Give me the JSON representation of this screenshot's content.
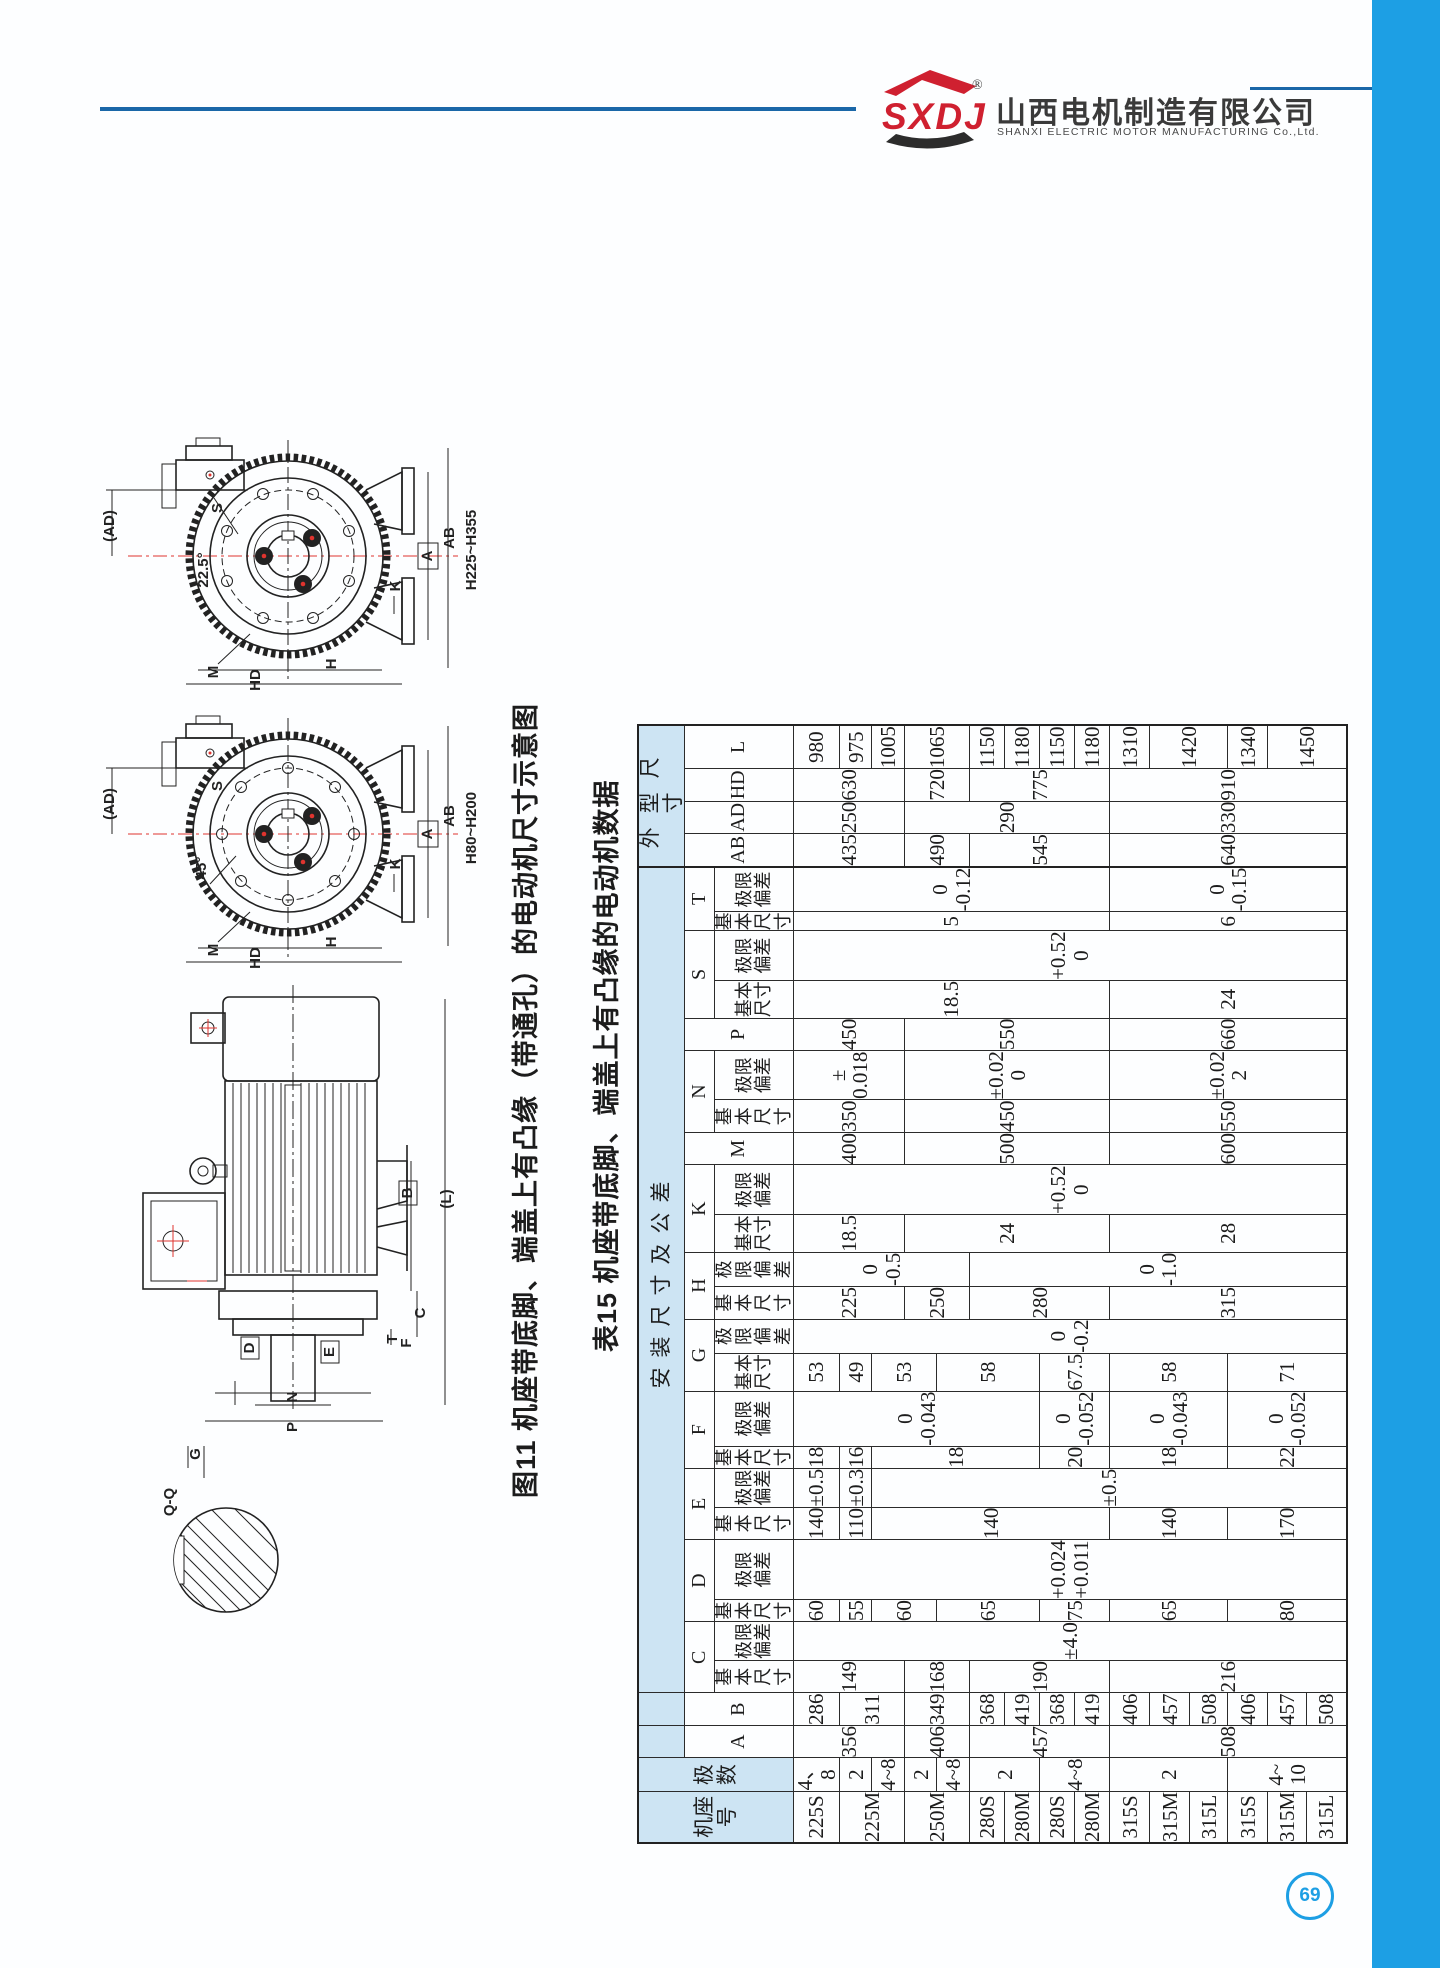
{
  "header": {
    "logo_text": "SXDJ",
    "reg_mark": "®",
    "company_cn": "山西电机制造有限公司",
    "company_en": "SHANXI ELECTRIC MOTOR MANUFACTURING Co.,Ltd."
  },
  "footer": {
    "page_number": "69"
  },
  "figure": {
    "caption": "图11 机座带底脚、端盖上有凸缘（带通孔）的电动机尺寸示意图",
    "labels": {
      "ad": "(AD)",
      "s": "S",
      "m": "M",
      "a": "A",
      "ab": "AB",
      "k": "K",
      "h": "H",
      "hd": "HD",
      "angle_top": "22.5°",
      "angle_bottom": "45°",
      "series_top": "H225~H355",
      "series_bottom": "H80~H200",
      "l": "(L)",
      "b": "B",
      "c": "C",
      "t": "T",
      "f": "F",
      "d": "D",
      "e": "E",
      "n": "N",
      "p": "P",
      "qq": "Q-Q",
      "g": "G"
    }
  },
  "table": {
    "title": "表15 机座带底脚、端盖上有凸缘的电动机数据",
    "col_widths": [
      48,
      50,
      40,
      38,
      50,
      60,
      48,
      66,
      56,
      70,
      48,
      70,
      70,
      70,
      62,
      70,
      66,
      70,
      50,
      50,
      58,
      48,
      56,
      56,
      56,
      70,
      40,
      36,
      46,
      52
    ],
    "head": [
      {
        "h": 40,
        "cells": [
          [
            "机座\n号",
            3,
            1,
            "hb"
          ],
          [
            "极数",
            3,
            1,
            "hb"
          ],
          [
            "",
            1,
            1,
            "hb"
          ],
          [
            "",
            1,
            1,
            "hb"
          ],
          [
            "安装尺寸及公差",
            1,
            22,
            "hb gi"
          ],
          [
            "外型尺寸",
            1,
            4,
            "hb go bl"
          ]
        ]
      },
      {
        "h": 30,
        "cells": [
          [
            "A",
            2,
            1,
            "hw"
          ],
          [
            "B",
            2,
            1,
            "hw"
          ],
          [
            "C",
            1,
            2,
            "hw"
          ],
          [
            "D",
            1,
            2,
            "hw"
          ],
          [
            "E",
            1,
            2,
            "hw"
          ],
          [
            "F",
            1,
            2,
            "hw"
          ],
          [
            "G",
            1,
            2,
            "hw"
          ],
          [
            "H",
            1,
            2,
            "hw"
          ],
          [
            "K",
            1,
            2,
            "hw"
          ],
          [
            "M",
            2,
            1,
            "hw"
          ],
          [
            "N",
            1,
            2,
            "hw"
          ],
          [
            "P",
            2,
            1,
            "hw"
          ],
          [
            "S",
            1,
            2,
            "hw"
          ],
          [
            "T",
            1,
            2,
            "hw"
          ],
          [
            "AB",
            2,
            1,
            "hw bl"
          ],
          [
            "AD",
            2,
            1,
            "hw"
          ],
          [
            "HD",
            2,
            1,
            "hw"
          ],
          [
            "L",
            2,
            1,
            "hw"
          ]
        ]
      },
      {
        "h": 74,
        "cells": [
          [
            "基本\n尺寸",
            1,
            1,
            "sub"
          ],
          [
            "极限\n偏差",
            1,
            1,
            "sub"
          ],
          [
            "基本\n尺寸",
            1,
            1,
            "sub"
          ],
          [
            "极限\n偏差",
            1,
            1,
            "sub"
          ],
          [
            "基本\n尺寸",
            1,
            1,
            "sub"
          ],
          [
            "极限\n偏差",
            1,
            1,
            "sub"
          ],
          [
            "基本\n尺寸",
            1,
            1,
            "sub"
          ],
          [
            "极限\n偏差",
            1,
            1,
            "sub"
          ],
          [
            "基本\n尺寸",
            1,
            1,
            "sub"
          ],
          [
            "极限\n偏差",
            1,
            1,
            "sub"
          ],
          [
            "基本\n尺寸",
            1,
            1,
            "sub"
          ],
          [
            "极限\n偏差",
            1,
            1,
            "sub"
          ],
          [
            "基本\n尺寸",
            1,
            1,
            "sub"
          ],
          [
            "极限\n偏差",
            1,
            1,
            "sub"
          ],
          [
            "基本\n尺寸",
            1,
            1,
            "sub"
          ],
          [
            "极限\n偏差",
            1,
            1,
            "sub"
          ],
          [
            "基本\n尺寸",
            1,
            1,
            "sub"
          ],
          [
            "极限\n偏差",
            1,
            1,
            "sub"
          ],
          [
            "基本\n尺寸",
            1,
            1,
            "sub"
          ],
          [
            "极限\n偏差",
            1,
            1,
            "sub"
          ]
        ]
      }
    ],
    "body": [
      {
        "h": 44,
        "cells": [
          [
            "225S"
          ],
          [
            "4、8"
          ],
          [
            "356",
            3
          ],
          [
            "286"
          ],
          [
            "149",
            3
          ],
          [
            "±4.0",
            15
          ],
          [
            "60"
          ],
          [
            "+0.024\n+0.011",
            15
          ],
          [
            "140"
          ],
          [
            "±0.5"
          ],
          [
            "18"
          ],
          [
            "0\n-0.043",
            7
          ],
          [
            "53"
          ],
          [
            "0\n-0.2",
            15
          ],
          [
            "225",
            3
          ],
          [
            "0\n-0.5",
            5
          ],
          [
            "18.5",
            3
          ],
          [
            "+0.52\n0",
            15
          ],
          [
            "400",
            3
          ],
          [
            "350",
            3
          ],
          [
            "±\n0.018",
            3
          ],
          [
            "450",
            3
          ],
          [
            "18.5",
            9
          ],
          [
            "+0.52\n0",
            15
          ],
          [
            "5",
            9
          ],
          [
            "0\n-0.12",
            9
          ],
          [
            "435",
            3,
            1,
            "bl"
          ],
          [
            "250",
            3
          ],
          [
            "630",
            3
          ],
          [
            "980"
          ]
        ]
      },
      {
        "h": 32,
        "cells": [
          [
            "225M",
            2
          ],
          [
            "2"
          ],
          [
            "311",
            2
          ],
          [
            "55"
          ],
          [
            "110"
          ],
          [
            "±0.3"
          ],
          [
            "16"
          ],
          [
            "49"
          ],
          [
            "975"
          ]
        ]
      },
      {
        "h": 33,
        "cells": [
          [
            "4~8"
          ],
          [
            "60",
            2
          ],
          [
            "140",
            7
          ],
          [
            "±0.5",
            13
          ],
          [
            "18",
            5
          ],
          [
            "53",
            2
          ],
          [
            "1005"
          ]
        ]
      },
      {
        "h": 32,
        "cells": [
          [
            "250M",
            2
          ],
          [
            "2"
          ],
          [
            "406",
            2
          ],
          [
            "349",
            2
          ],
          [
            "168",
            2
          ],
          [
            "250",
            2
          ],
          [
            "24",
            6
          ],
          [
            "500",
            6
          ],
          [
            "450",
            6
          ],
          [
            "±0.02\n0",
            6
          ],
          [
            "550",
            6
          ],
          [
            "490",
            2,
            1,
            "bl"
          ],
          [
            "290",
            6
          ],
          [
            "720",
            2
          ],
          [
            "1065",
            2
          ]
        ]
      },
      {
        "h": 33,
        "cells": [
          [
            "4~8"
          ],
          [
            "65",
            3
          ],
          [
            "58",
            3
          ]
        ]
      },
      {
        "h": 35,
        "cells": [
          [
            "280S"
          ],
          [
            "2",
            2
          ],
          [
            "457",
            4
          ],
          [
            "368"
          ],
          [
            "190",
            4
          ],
          [
            "280",
            4
          ],
          [
            "0\n-1.0",
            10
          ],
          [
            "545",
            4,
            1,
            "bl"
          ],
          [
            "775",
            4
          ],
          [
            "1150"
          ]
        ]
      },
      {
        "h": 35,
        "cells": [
          [
            "280M"
          ],
          [
            "419"
          ],
          [
            "1180"
          ]
        ]
      },
      {
        "h": 35,
        "cells": [
          [
            "280S"
          ],
          [
            "4~8",
            2
          ],
          [
            "368"
          ],
          [
            "75",
            2
          ],
          [
            "20",
            2
          ],
          [
            "0\n-0.052",
            2
          ],
          [
            "67.5",
            2
          ],
          [
            "1150"
          ]
        ]
      },
      {
        "h": 35,
        "cells": [
          [
            "280M"
          ],
          [
            "419"
          ],
          [
            "1180"
          ]
        ]
      },
      {
        "h": 40,
        "cells": [
          [
            "315S"
          ],
          [
            "2",
            3
          ],
          [
            "508",
            6
          ],
          [
            "406"
          ],
          [
            "216",
            6
          ],
          [
            "65",
            3
          ],
          [
            "140",
            3
          ],
          [
            "18",
            3
          ],
          [
            "0\n-0.043",
            3
          ],
          [
            "58",
            3
          ],
          [
            "315",
            6
          ],
          [
            "28",
            6
          ],
          [
            "600",
            6
          ],
          [
            "550",
            6
          ],
          [
            "±0.02\n2",
            6
          ],
          [
            "660",
            6
          ],
          [
            "24",
            6
          ],
          [
            "6",
            6
          ],
          [
            "0\n-0.15",
            6
          ],
          [
            "640",
            6,
            1,
            "bl"
          ],
          [
            "330",
            6
          ],
          [
            "910",
            6
          ],
          [
            "1310"
          ]
        ]
      },
      {
        "h": 40,
        "cells": [
          [
            "315M"
          ],
          [
            "457"
          ],
          [
            "1420",
            2
          ]
        ]
      },
      {
        "h": 38,
        "cells": [
          [
            "315L"
          ],
          [
            "508"
          ]
        ]
      },
      {
        "h": 40,
        "cells": [
          [
            "315S"
          ],
          [
            "4~\n10",
            3
          ],
          [
            "406"
          ],
          [
            "80",
            3
          ],
          [
            "170",
            3
          ],
          [
            "22",
            3
          ],
          [
            "0\n-0.052",
            3
          ],
          [
            "71",
            3
          ],
          [
            "1340"
          ]
        ]
      },
      {
        "h": 39,
        "cells": [
          [
            "315M"
          ],
          [
            "457"
          ],
          [
            "1450",
            2
          ]
        ]
      },
      {
        "h": 40,
        "cells": [
          [
            "315L"
          ],
          [
            "508"
          ]
        ]
      }
    ]
  }
}
